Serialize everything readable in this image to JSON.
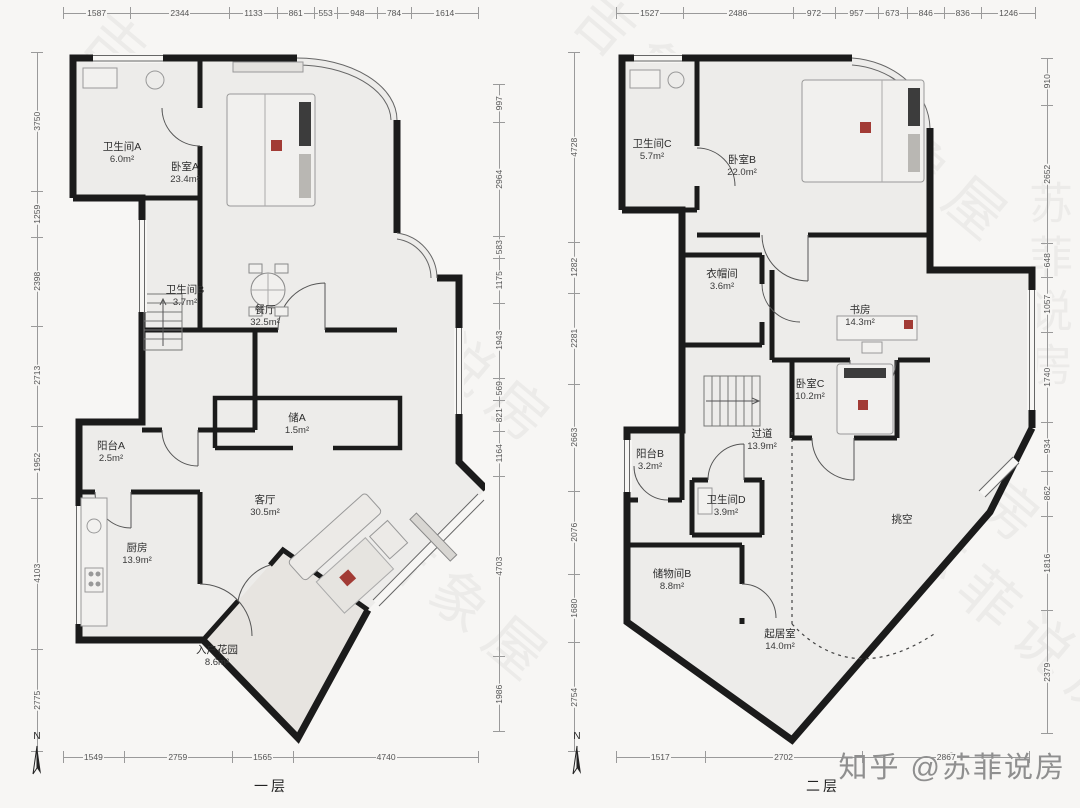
{
  "footer": {
    "credit": "知乎 @苏菲说房"
  },
  "watermark": {
    "brand_a": "吉象屋",
    "brand_b": "苏菲说房",
    "items": [
      {
        "t": "吉象屋",
        "x": 70,
        "y": 50
      },
      {
        "t": "苏菲说房",
        "x": 300,
        "y": 300
      },
      {
        "t": "吉象屋",
        "x": 560,
        "y": 30
      },
      {
        "t": "苏菲说房",
        "x": 60,
        "y": 480
      },
      {
        "t": "吉象屋",
        "x": 820,
        "y": 120
      },
      {
        "t": "苏菲说房",
        "x": 790,
        "y": 400
      },
      {
        "t": "吉象屋",
        "x": 360,
        "y": 560
      },
      {
        "t": "苏菲说房",
        "x": 880,
        "y": 580
      }
    ]
  },
  "compass": {
    "label": "N"
  },
  "plans": {
    "left": {
      "title": "一层",
      "dims": {
        "top": [
          "1587",
          "2344",
          "1133",
          "861",
          "553",
          "948",
          "784",
          "1614"
        ],
        "bottom": [
          "1549",
          "2759",
          "1565",
          "4740"
        ],
        "left": [
          "3750",
          "1259",
          "2398",
          "2713",
          "1952",
          "4103",
          "2775"
        ],
        "right": [
          "997",
          "2964",
          "583",
          "1175",
          "1943",
          "569",
          "821",
          "1164",
          "4703",
          "1986"
        ]
      },
      "rooms": [
        {
          "name": "卫生间A",
          "area": "6.0m²",
          "x": 57,
          "y": 125
        },
        {
          "name": "卧室A",
          "area": "23.4m²",
          "x": 120,
          "y": 145
        },
        {
          "name": "卫生间B",
          "area": "3.7m²",
          "x": 120,
          "y": 268
        },
        {
          "name": "餐厅",
          "area": "32.5m²",
          "x": 200,
          "y": 288
        },
        {
          "name": "储A",
          "area": "1.5m²",
          "x": 232,
          "y": 396
        },
        {
          "name": "阳台A",
          "area": "2.5m²",
          "x": 46,
          "y": 424
        },
        {
          "name": "客厅",
          "area": "30.5m²",
          "x": 200,
          "y": 478
        },
        {
          "name": "厨房",
          "area": "13.9m²",
          "x": 72,
          "y": 526
        },
        {
          "name": "入户花园",
          "area": "8.6m²",
          "x": 152,
          "y": 628
        }
      ]
    },
    "right": {
      "title": "二层",
      "dims": {
        "top": [
          "1527",
          "2486",
          "972",
          "957",
          "673",
          "846",
          "836",
          "1246"
        ],
        "bottom": [
          "1517",
          "2702",
          "2867"
        ],
        "left": [
          "4728",
          "1282",
          "2281",
          "2663",
          "2076",
          "1680",
          "2754"
        ],
        "right": [
          "910",
          "2652",
          "648",
          "1057",
          "1740",
          "934",
          "862",
          "1816",
          "2379"
        ]
      },
      "rooms": [
        {
          "name": "卫生间C",
          "area": "5.7m²",
          "x": 40,
          "y": 122
        },
        {
          "name": "卧室B",
          "area": "22.0m²",
          "x": 130,
          "y": 138
        },
        {
          "name": "衣帽间",
          "area": "3.6m²",
          "x": 110,
          "y": 252
        },
        {
          "name": "书房",
          "area": "14.3m²",
          "x": 248,
          "y": 288
        },
        {
          "name": "卧室C",
          "area": "10.2m²",
          "x": 198,
          "y": 362
        },
        {
          "name": "过道",
          "area": "13.9m²",
          "x": 150,
          "y": 412
        },
        {
          "name": "阳台B",
          "area": "3.2m²",
          "x": 38,
          "y": 432
        },
        {
          "name": "卫生间D",
          "area": "3.9m²",
          "x": 114,
          "y": 478
        },
        {
          "name": "储物间B",
          "area": "8.8m²",
          "x": 60,
          "y": 552
        },
        {
          "name": "挑空",
          "area": "",
          "x": 290,
          "y": 492
        },
        {
          "name": "起居室",
          "area": "14.0m²",
          "x": 168,
          "y": 612
        }
      ]
    }
  }
}
